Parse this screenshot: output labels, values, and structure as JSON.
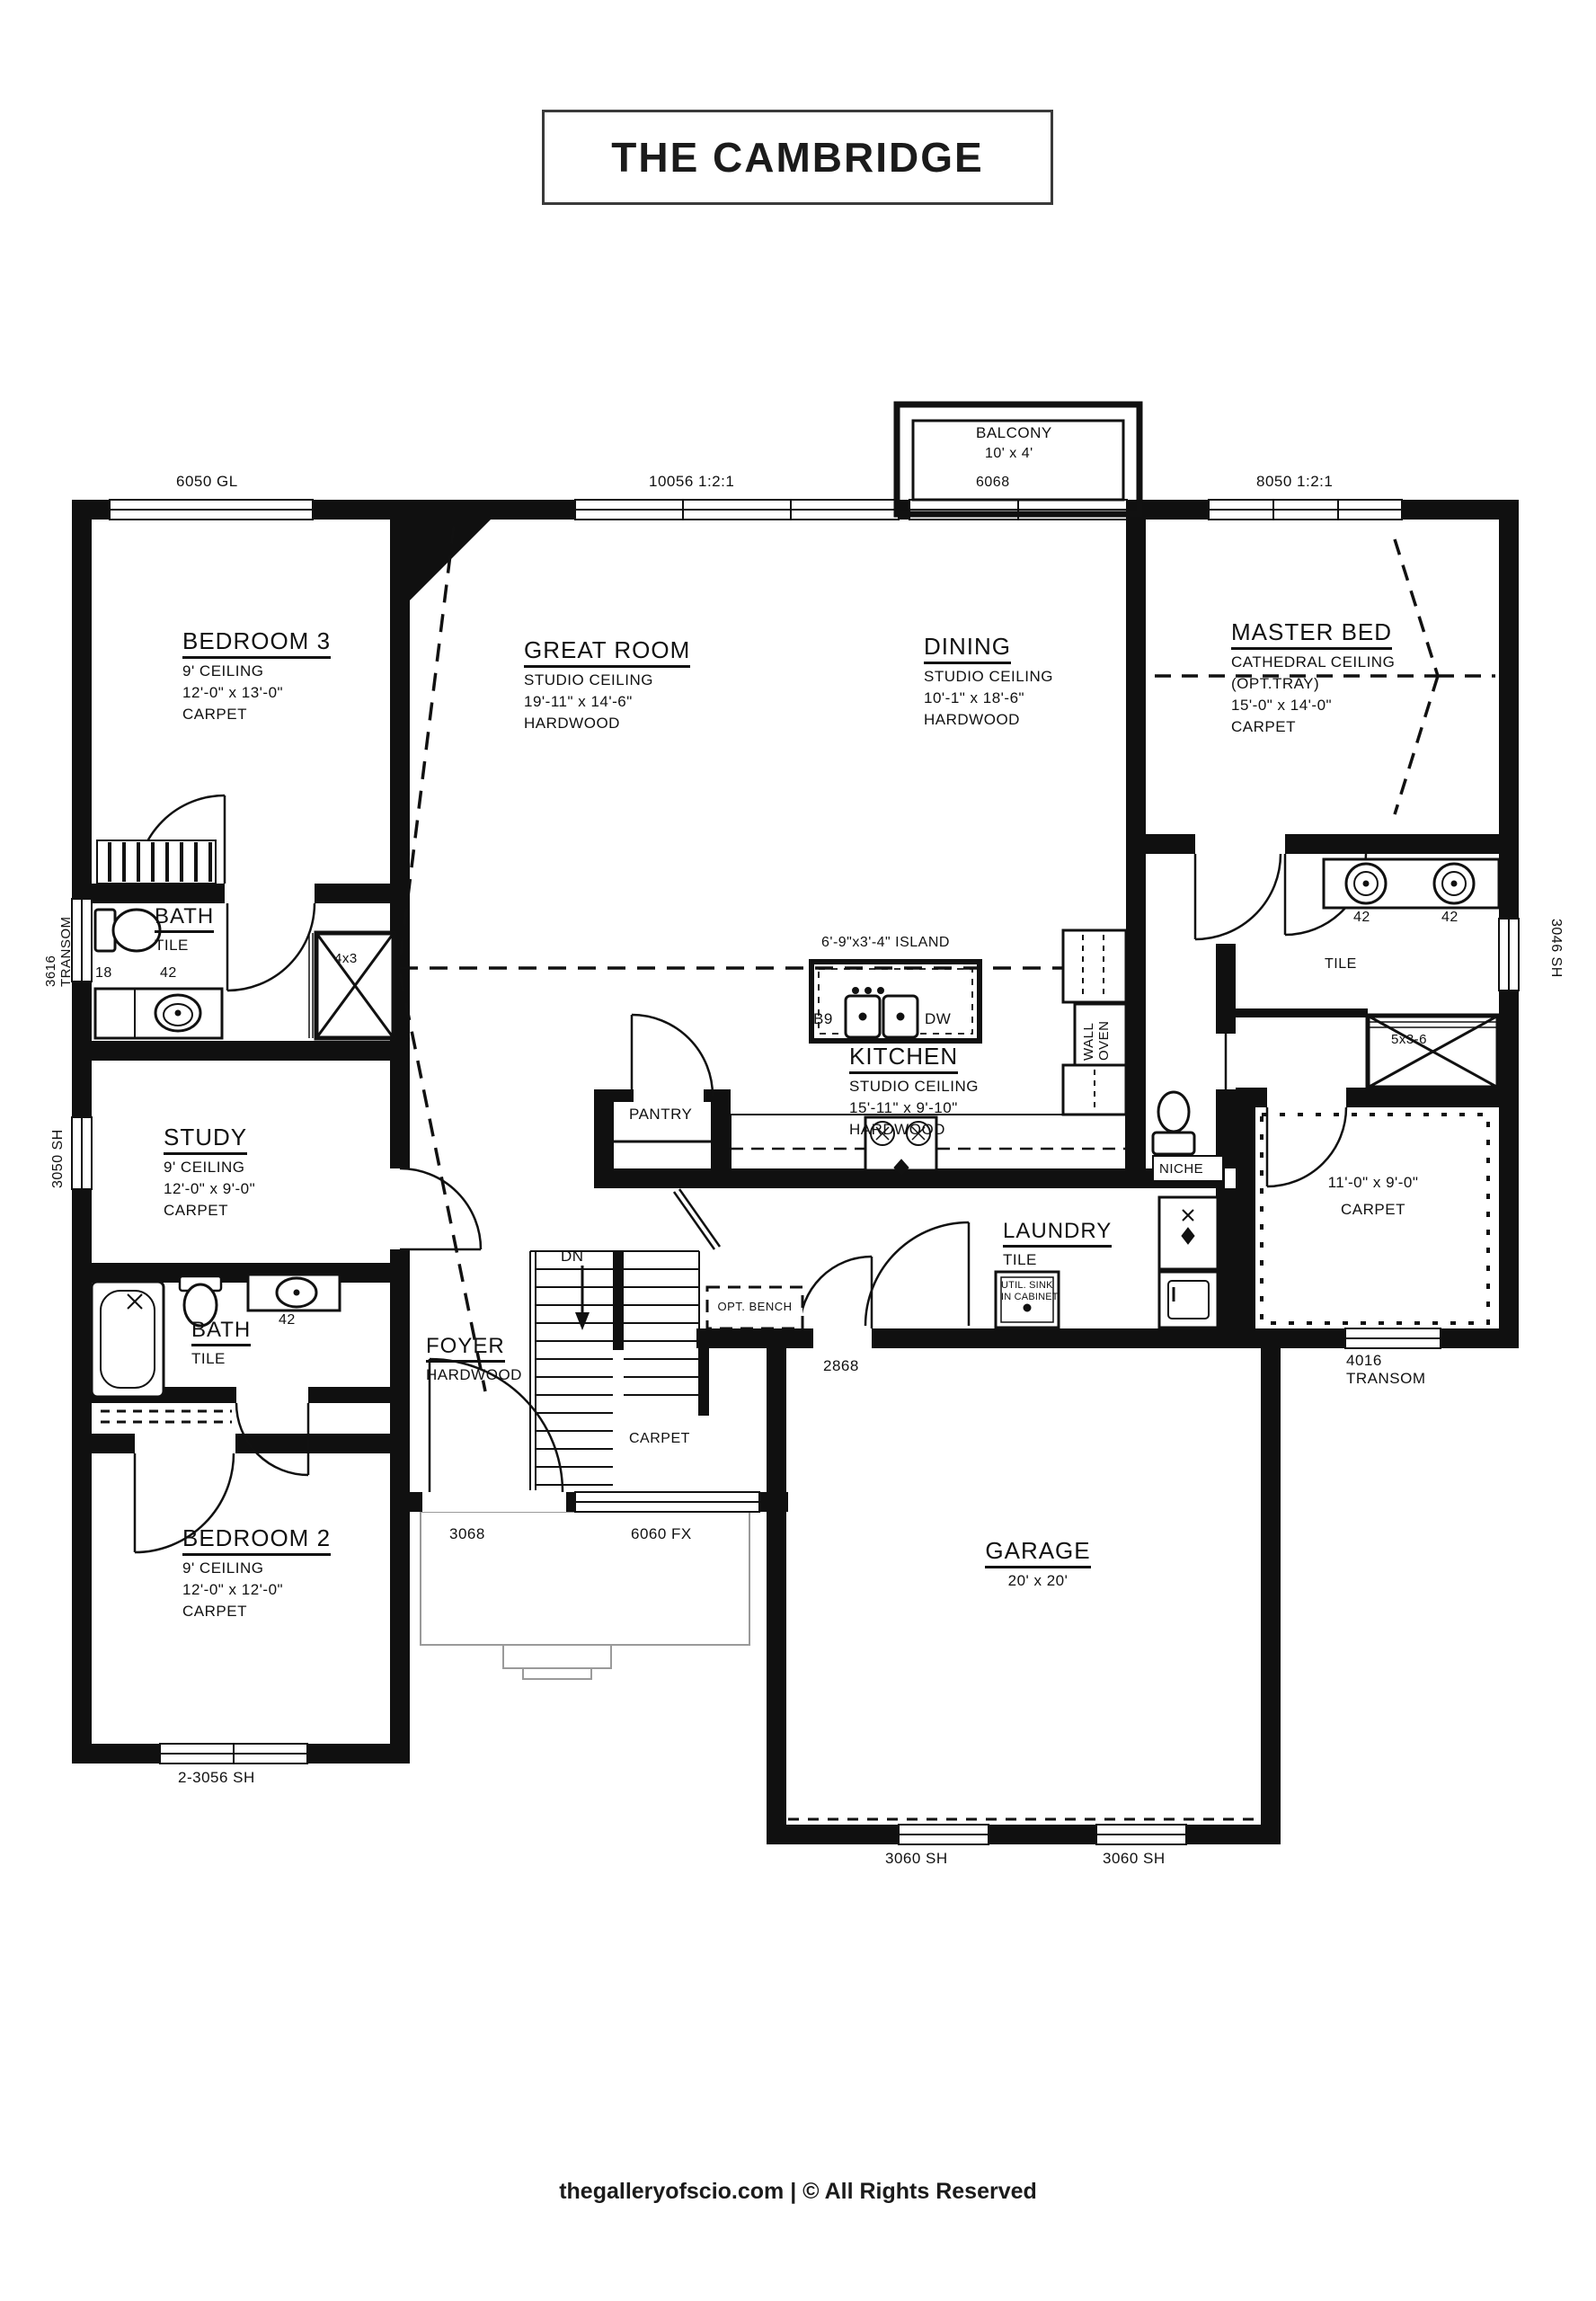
{
  "title": "THE CAMBRIDGE",
  "footer": "thegalleryofscio.com | © All Rights Reserved",
  "balcony": {
    "name": "BALCONY",
    "size": "10' x 4'"
  },
  "windows": {
    "gl6050": "6050 GL",
    "w10056": "10056 1:2:1",
    "door6068": "6068",
    "w8050": "8050 1:2:1",
    "transom3616_num": "3616",
    "transom3616_word": "TRANSOM",
    "sh3050": "3050 SH",
    "sh3046": "3046 SH",
    "sh3056": "2-3056 SH",
    "door3068": "3068",
    "fx6060": "6060 FX",
    "sh3060a": "3060 SH",
    "sh3060b": "3060 SH",
    "transom4016_num": "4016",
    "transom4016_word": "TRANSOM",
    "door2868": "2868"
  },
  "rooms": {
    "bedroom3": {
      "name": "BEDROOM 3",
      "ceiling": "9' CEILING",
      "size": "12'-0\" x 13'-0\"",
      "floor": "CARPET"
    },
    "great_room": {
      "name": "GREAT ROOM",
      "ceiling": "STUDIO CEILING",
      "size": "19'-11\" x 14'-6\"",
      "floor": "HARDWOOD"
    },
    "dining": {
      "name": "DINING",
      "ceiling": "STUDIO CEILING",
      "size": "10'-1\" x 18'-6\"",
      "floor": "HARDWOOD"
    },
    "master": {
      "name": "MASTER BED",
      "ceiling": "CATHEDRAL CEILING",
      "ceiling_opt": "(OPT.TRAY)",
      "size": "15'-0\" x 14'-0\"",
      "floor": "CARPET"
    },
    "bath1": {
      "name": "BATH",
      "floor": "TILE",
      "dim_a": "18",
      "dim_b": "42"
    },
    "study": {
      "name": "STUDY",
      "ceiling": "9' CEILING",
      "size": "12'-0\" x 9'-0\"",
      "floor": "CARPET"
    },
    "kitchen": {
      "name": "KITCHEN",
      "ceiling": "STUDIO CEILING",
      "size": "15'-11\" x 9'-10\"",
      "floor": "HARDWOOD"
    },
    "bath2": {
      "name": "BATH",
      "floor": "TILE",
      "dim": "42"
    },
    "bedroom2": {
      "name": "BEDROOM 2",
      "ceiling": "9' CEILING",
      "size": "12'-0\" x 12'-0\"",
      "floor": "CARPET"
    },
    "foyer": {
      "name": "FOYER",
      "floor": "HARDWOOD"
    },
    "laundry": {
      "name": "LAUNDRY",
      "floor": "TILE",
      "util_line1": "UTIL. SINK",
      "util_line2": "IN CABINET"
    },
    "garage": {
      "name": "GARAGE",
      "size": "20' x 20'"
    },
    "master_bath": {
      "floor": "TILE",
      "sink_a": "42",
      "sink_b": "42"
    },
    "wic": {
      "size": "11'-0\" x 9'-0\"",
      "floor": "CARPET"
    }
  },
  "features": {
    "island": "6'-9\"x3'-4\" ISLAND",
    "b9": "B9",
    "dw": "DW",
    "pantry": "PANTRY",
    "wall_oven_line1": "WALL",
    "wall_oven_line2": "OVEN",
    "niche": "NICHE",
    "closet_4x3": "4x3",
    "closet_5x36": "5x3-6",
    "dn": "DN",
    "stairs_floor": "CARPET",
    "opt_bench": "OPT. BENCH"
  }
}
